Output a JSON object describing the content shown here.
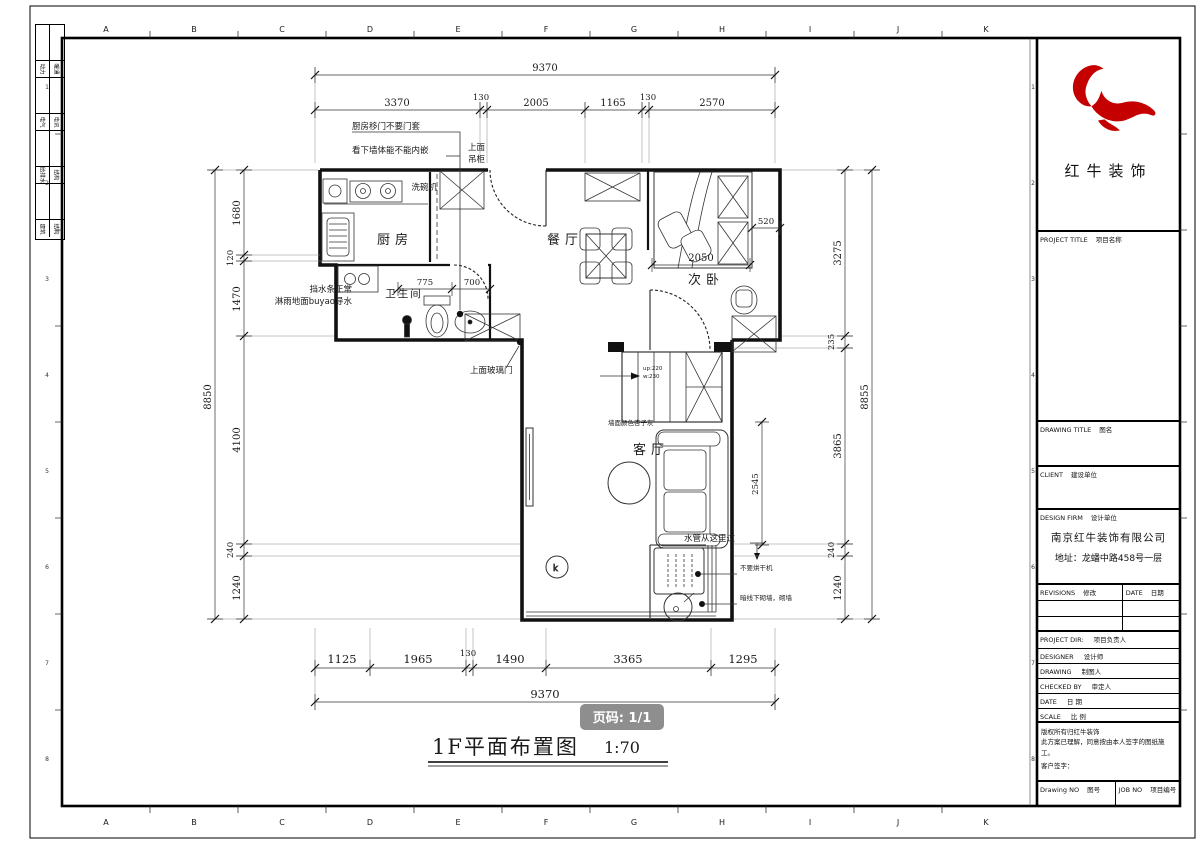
{
  "sheet": {
    "bg": "#ffffff",
    "line_color": "#1a1a1a"
  },
  "logo": {
    "name": "红牛装饰",
    "color": "#c40000"
  },
  "badge": {
    "text": "页码: 1/1",
    "bg": "#8e8e8e"
  },
  "title": {
    "name": "1F平面布置图",
    "scale": "1:70"
  },
  "rooms": {
    "kitchen": "厨房",
    "dining": "餐厅",
    "bedroom": "次卧",
    "bathroom": "卫生间",
    "living": "客厅"
  },
  "dims": {
    "top_total": "9370",
    "top": [
      "3370",
      "130",
      "2005",
      "1165",
      "130",
      "2570"
    ],
    "bottom": [
      "1125",
      "1965",
      "130",
      "1490",
      "3365",
      "1295"
    ],
    "bottom_total": "9370",
    "left_total": "8850",
    "left": [
      "1680",
      "120",
      "1470",
      "4100",
      "240",
      "1240"
    ],
    "right": [
      "3275",
      "235",
      "3865",
      "240",
      "1240"
    ],
    "right_total": "8855",
    "bedroom_width": "2050",
    "wardrobe_depth": "520",
    "bath_a": "775",
    "bath_b": "700",
    "living_height": "2545"
  },
  "stairs": {
    "line1": "up:220",
    "line2": "w:230"
  },
  "annotations": {
    "kitchen_door": "厨房移门不要门套",
    "wall_embed": "看下墙体能不能内嵌",
    "cabinet_l1": "上面",
    "cabinet_l2": "吊柜",
    "dishwasher": "洗碗机",
    "water_bar": "挡水条正常",
    "shower_floor": "淋雨地面buyao导水",
    "glass_door": "上面玻璃门",
    "wall_color": "墙面颜色杏子灰",
    "pipe": "水管从这里过",
    "no_dryer": "不要烘干机",
    "wall_line": "暗线下砌墙，砌墙",
    "plant": "k"
  },
  "title_block": {
    "project_title": {
      "en": "PROJECT TITLE",
      "cn": "项目名称"
    },
    "drawing_title": {
      "en": "DRAWING TITLE",
      "cn": "图名"
    },
    "client": {
      "en": "CLIENT",
      "cn": "建设单位"
    },
    "design_firm": {
      "en": "DESIGN FIRM",
      "cn": "设计单位"
    },
    "firm_name": "南京红牛装饰有限公司",
    "firm_address": "地址：龙蟠中路458号一层",
    "revisions": {
      "en": "REVISIONS",
      "cn": "修改"
    },
    "rev_date": {
      "en": "DATE",
      "cn": "日期"
    },
    "project_dir": {
      "en": "PROJECT DIR:",
      "cn": "项目负责人"
    },
    "designer": {
      "en": "DESIGNER",
      "cn": "设计师"
    },
    "drawing": {
      "en": "DRAWING",
      "cn": "制图人"
    },
    "checked": {
      "en": "CHECKED BY",
      "cn": "审定人"
    },
    "date": {
      "en": "DATE",
      "cn": "日 期"
    },
    "scale": {
      "en": "SCALE",
      "cn": "比 例"
    },
    "copyright1": "版权所有归红牛装饰",
    "copyright2": "此方案已理解，同意按由本人签字的图纸施工。",
    "customer_sign": "客户签字：",
    "drawing_no": {
      "en": "Drawing NO",
      "cn": "图号"
    },
    "job_no": {
      "en": "JOB NO",
      "cn": "项目编号"
    }
  },
  "ruler": {
    "letters": [
      "A",
      "B",
      "C",
      "D",
      "E",
      "F",
      "G",
      "H",
      "I",
      "J",
      "K"
    ],
    "numbers": [
      "1",
      "2",
      "3",
      "4",
      "5",
      "6",
      "7",
      "8"
    ]
  },
  "signoff": {
    "rows": [
      {
        "l": "动力",
        "r": "暖通"
      },
      {
        "l": "电气",
        "r": "电讯"
      },
      {
        "l": "给排水",
        "r": "结构"
      },
      {
        "l": "建筑",
        "r": "结构"
      }
    ]
  }
}
